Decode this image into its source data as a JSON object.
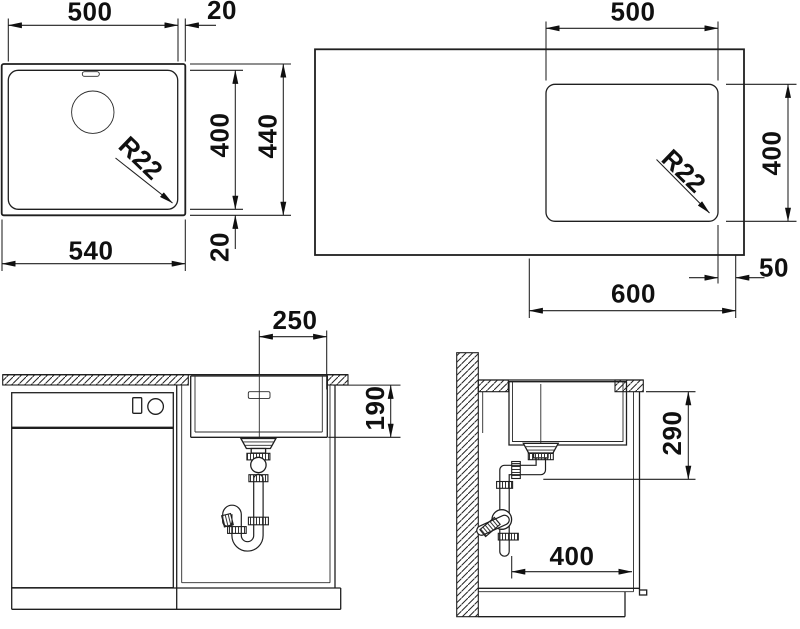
{
  "drawing": {
    "kind": "sink installation technical drawing",
    "colors": {
      "line": "#1f1f1f",
      "background": "#ffffff"
    },
    "views": {
      "sink_plan": {
        "dims": {
          "bowl_width": "500",
          "rim_right": "20",
          "bowl_depth": "400",
          "overall_depth": "440",
          "overall_width": "540",
          "rim_bottom": "20",
          "corner_radius": "R22"
        }
      },
      "countertop_plan": {
        "dims": {
          "cutout_width": "500",
          "cutout_depth": "400",
          "corner_radius": "R22",
          "edge_clearance": "50",
          "cabinet_width": "600"
        }
      },
      "front_section": {
        "dims": {
          "drain_offset": "250",
          "bowl_height": "190"
        }
      },
      "side_section": {
        "dims": {
          "clearance_height": "290",
          "drain_depth": "400"
        }
      }
    }
  }
}
